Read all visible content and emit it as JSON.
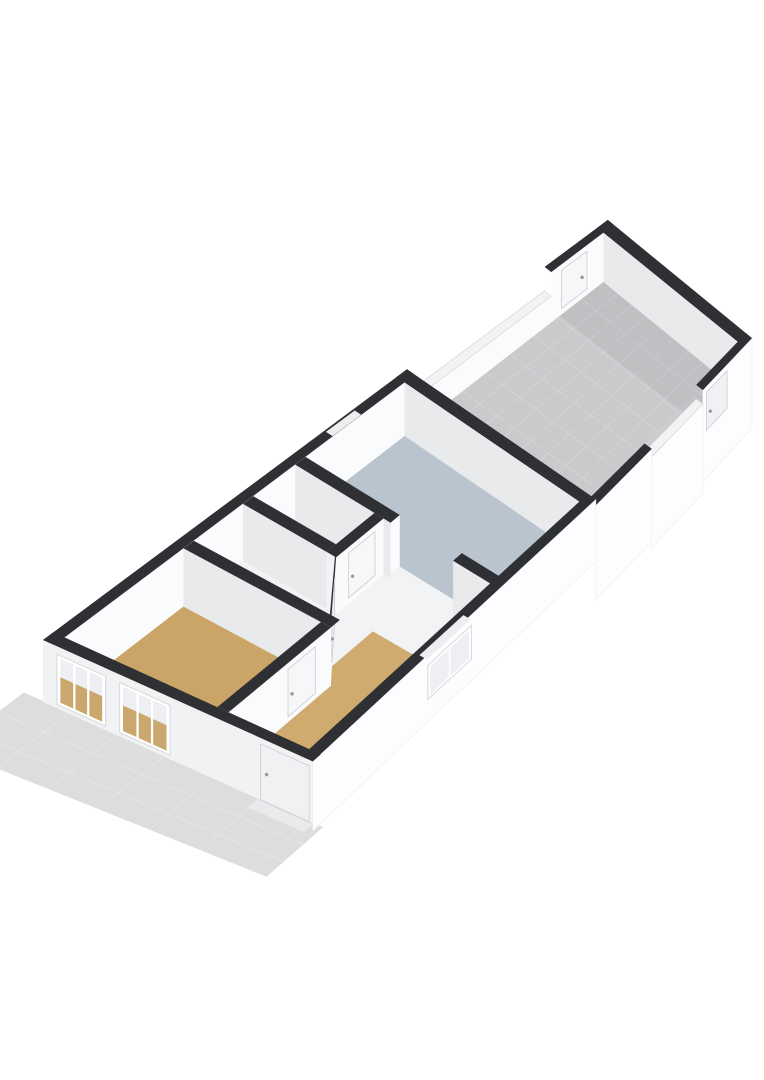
{
  "view": {
    "kind": "3d-floorplan-render",
    "background": "#ffffff"
  },
  "rooms": [
    {
      "id": "living-room",
      "floor_finish": "wood",
      "floor_color": "#cba568"
    },
    {
      "id": "entry-hall",
      "floor_finish": "wood",
      "floor_color": "#d0ab70"
    },
    {
      "id": "storage-room-front",
      "floor_finish": "light",
      "floor_color": "#f2f3f4"
    },
    {
      "id": "storage-room-back",
      "floor_finish": "light",
      "floor_color": "#f2f3f4"
    },
    {
      "id": "kitchen",
      "floor_finish": "blue-gray",
      "floor_color": "#bac4cf"
    },
    {
      "id": "courtyard",
      "floor_finish": "gray-tile",
      "floor_color": "#c9cacc"
    },
    {
      "id": "shed",
      "floor_finish": "gray-tile",
      "floor_color": "#c9cacc"
    },
    {
      "id": "sidewalk",
      "floor_finish": "pavement",
      "floor_color": "#dcddde"
    }
  ],
  "colors": {
    "band": "#2f3033",
    "wallBright": "#fafbfc",
    "wallShaded": "#e8eaec",
    "wallFacade": "#f1f2f4",
    "wallOuter": "#fcfdfe",
    "wallAngled": "#f5f6f8",
    "floorWood": "#cba568",
    "floorWoodHall": "#d0ab70",
    "floorWhite": "#f2f3f4",
    "floorBlue": "#bac4cf",
    "tile": "#c9cacc",
    "tileLine": "#d2d3d5",
    "shedShadow": "rgba(40,45,55,0.055)",
    "sidewalk": "#dcddde",
    "sidewalkLine": "#e4e5e6",
    "fenceTop": "#f2f3f5",
    "fenceEdge": "#d8d9db",
    "outerEdge": "#ededef",
    "doorLeaf": "#f0f1f3",
    "doorLeafBright": "#f6f7f8",
    "doorOutline": "#cbcdd0",
    "handle": "#97989b",
    "windowFrame": "#ffffff",
    "windowOutline": "#d7d8da",
    "glass": "#edeff2",
    "glassTan": "#c9a76d",
    "notch": "#eceef0",
    "step": "#e9eaec"
  },
  "projection": {
    "x0": 43,
    "y0": 640,
    "ax": 0.8,
    "ay": -0.595,
    "bx": 0.87,
    "foreshorten": 0.3,
    "slope0": 0.45,
    "slopeGain": 0.37,
    "wallH0": 56,
    "wallHDrop": 12,
    "groundDrop": 5
  },
  "elements": [
    {
      "type": "sidewalk",
      "name": "sidewalk",
      "u1": -92,
      "u2": 0,
      "v1": -22,
      "v2": 322,
      "lineVs": [
        30,
        85,
        140,
        195,
        250,
        305
      ],
      "lineUs": [
        -32,
        -64
      ]
    },
    {
      "type": "tiles",
      "name": "courtyard-floor",
      "u1": 455,
      "u2": 693,
      "v1": 13,
      "v2": 297,
      "step": 30
    },
    {
      "type": "shadow",
      "name": "shed-floor-shadow",
      "u1": 638,
      "u2": 693,
      "v1": 13,
      "v2": 297
    },
    {
      "type": "wallA",
      "name": "courtyard-left-fence",
      "v": 0,
      "t": 13,
      "u1": 455,
      "u2": 627,
      "topDrop": 24,
      "top": "white",
      "face": "fence"
    },
    {
      "type": "wallA",
      "name": "shed-northwest-wall",
      "v": 0,
      "t": 13,
      "u1": 627,
      "u2": 706,
      "topDrop": 0,
      "top": "dark",
      "face": "bright"
    },
    {
      "type": "door",
      "name": "shed-door-northwest",
      "plane": "A",
      "v": 13,
      "u1": 640,
      "u2": 672,
      "leaf": "doorLeafBright",
      "handleAt": "end"
    },
    {
      "type": "wallB",
      "name": "shed-back-wall",
      "u": 693,
      "t": 13,
      "v1": 0,
      "v2": 310,
      "v1f": 13,
      "v2f": 297,
      "face": "shaded"
    },
    {
      "type": "wallA",
      "name": "shed-southeast-wall",
      "v": 297,
      "t": 13,
      "u1": 627,
      "u2": 706,
      "topDrop": 0,
      "top": "dark",
      "face": "outer",
      "outerDeep": 46
    },
    {
      "type": "door",
      "name": "shed-door-southeast",
      "plane": "A",
      "v": 310,
      "u1": 633,
      "u2": 666,
      "leaf": "doorLeaf",
      "handleAt": "start"
    },
    {
      "type": "wallA",
      "name": "courtyard-right-fence-back",
      "v": 297,
      "t": 13,
      "u1": 545,
      "u2": 627,
      "topDrop": 14,
      "top": "white",
      "face": "outer",
      "outerDeep": 58
    },
    {
      "type": "wallA",
      "name": "courtyard-right-fence-front",
      "v": 297,
      "t": 13,
      "u1": 455,
      "u2": 545,
      "topDrop": 6,
      "top": "dark",
      "face": "outer",
      "outerDeep": 52
    },
    {
      "type": "floor",
      "name": "hallway-floor",
      "u1": 13,
      "u2": 442,
      "v1": 13,
      "v2": 297,
      "fill": "floorWhite"
    },
    {
      "type": "floor",
      "name": "living-room-floor",
      "u1": 13,
      "u2": 163,
      "v1": 13,
      "v2": 190,
      "fill": "floorWood"
    },
    {
      "type": "floor",
      "name": "entry-hall-floor",
      "u1": 13,
      "u2": 238,
      "v1": 190,
      "v2": 297,
      "fill": "floorWoodHall"
    },
    {
      "type": "floor",
      "name": "kitchen-floor",
      "u1": 317,
      "u2": 442,
      "v1": 13,
      "v2": 297,
      "fill": "floorBlue"
    },
    {
      "type": "wallA",
      "name": "house-left-wall",
      "v": 0,
      "t": 13,
      "u1": 0,
      "u2": 455,
      "topDrop": 0,
      "top": "dark",
      "face": "bright"
    },
    {
      "type": "notch",
      "name": "left-wall-window-gap",
      "u1": 352,
      "u2": 388,
      "v1": 2,
      "v2": 12
    },
    {
      "type": "wallB",
      "name": "house-back-wall",
      "u": 442,
      "t": 13,
      "v1": 0,
      "v2": 310,
      "v1f": 13,
      "v2f": 297,
      "face": "shaded"
    },
    {
      "type": "wallB",
      "name": "kitchen-front-wall-left",
      "u": 304,
      "t": 13,
      "v1": 13,
      "v2": 150,
      "face": "shaded",
      "jambEnd": true
    },
    {
      "type": "wallB",
      "name": "kitchen-front-wall-right",
      "u": 304,
      "t": 13,
      "v1": 240,
      "v2": 297,
      "face": "shaded"
    },
    {
      "type": "wallB",
      "name": "storage-divider-wall",
      "u": 238,
      "t": 13,
      "v1": 13,
      "v2": 127,
      "face": "shaded"
    },
    {
      "type": "wallA",
      "name": "storage-rooms-right-wall",
      "v": 127,
      "t": 13,
      "u1": 238,
      "u2": 304,
      "topDrop": 0,
      "top": "dark",
      "face": "bright"
    },
    {
      "type": "door",
      "name": "interior-door-storage-back",
      "plane": "A",
      "v": 140,
      "u1": 255,
      "u2": 292,
      "leaf": "doorLeafBright",
      "handleAt": "start"
    },
    {
      "type": "wallDiag",
      "name": "hall-angled-wall",
      "o1": [
        163,
        203
      ],
      "o2": [
        238,
        140
      ],
      "i1": [
        176,
        190
      ],
      "i2": [
        251,
        127
      ]
    },
    {
      "type": "doorDiag",
      "name": "interior-door-angled",
      "o1": [
        163,
        203
      ],
      "o2": [
        238,
        140
      ],
      "f1": 0.26,
      "f2": 0.8
    },
    {
      "type": "wallB",
      "name": "living-room-back-wall",
      "u": 163,
      "t": 13,
      "v1": 13,
      "v2": 203,
      "face": "shaded"
    },
    {
      "type": "wallA",
      "name": "entry-hall-left-wall",
      "v": 190,
      "t": 13,
      "u1": 13,
      "u2": 163,
      "topDrop": 0,
      "top": "dark",
      "face": "bright"
    },
    {
      "type": "door",
      "name": "interior-door-hall",
      "plane": "A",
      "v": 203,
      "u1": 100,
      "u2": 140,
      "leaf": "doorLeafBright",
      "handleAt": "start"
    },
    {
      "type": "wallA",
      "name": "house-right-wall",
      "v": 297,
      "t": 13,
      "u1": 0,
      "u2": 455,
      "topDrop": 0,
      "top": "dark",
      "face": "outer",
      "outerDeep": 14
    },
    {
      "type": "notch",
      "name": "right-wall-window-gap",
      "u1": 185,
      "u2": 255,
      "v1": 299,
      "v2": 309
    },
    {
      "type": "windowA",
      "name": "side-window",
      "v": 310,
      "u1": 185,
      "u2": 255,
      "top": 6,
      "bottom": 40,
      "mullions": 1
    },
    {
      "type": "wallB",
      "name": "house-facade",
      "u": 0,
      "t": 13,
      "v1": 0,
      "v2": 310,
      "face": "facade"
    },
    {
      "type": "windowB",
      "name": "facade-window-left",
      "u": 0,
      "v1": 16,
      "v2": 72,
      "top": 8,
      "bottom": 58,
      "mullions": 2
    },
    {
      "type": "windowB",
      "name": "facade-window-middle",
      "u": 0,
      "v1": 88,
      "v2": 146,
      "top": 8,
      "bottom": 58,
      "mullions": 2
    },
    {
      "type": "door",
      "name": "front-door",
      "plane": "B",
      "u": 0,
      "v1": 250,
      "v2": 306,
      "leaf": "doorLeaf",
      "handleAt": "start",
      "tall": true
    },
    {
      "type": "step",
      "name": "front-door-step",
      "u1": -14,
      "u2": 0,
      "v1": 246,
      "v2": 310
    }
  ]
}
